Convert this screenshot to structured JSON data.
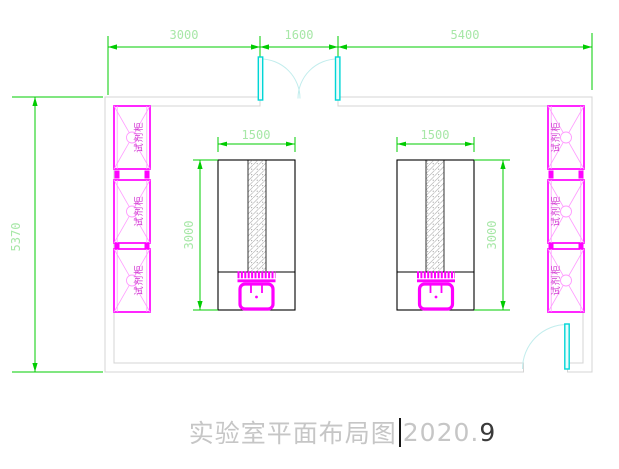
{
  "drawing": {
    "title": {
      "main": "实验室平面布局图",
      "year": "2020.",
      "suffix": "9"
    },
    "dimensions": {
      "top": {
        "seg1": "3000",
        "seg2": "1600",
        "seg3": "5400"
      },
      "left_height": "5370",
      "bench_width": "1500",
      "bench_depth": "3000"
    },
    "labels": {
      "cabinet": "试剂柜"
    },
    "colors": {
      "dimension_line": "#00cc00",
      "dimension_text": "#a7e7a7",
      "wall": "#d4d4d4",
      "cabinet": "#ff00ff",
      "cabinet_detail": "#ff9bff",
      "door_leaf": "#00d6d6",
      "door_swing": "#c2eded",
      "bench_outline": "#000000",
      "title_text": "#c6c6c6"
    }
  }
}
